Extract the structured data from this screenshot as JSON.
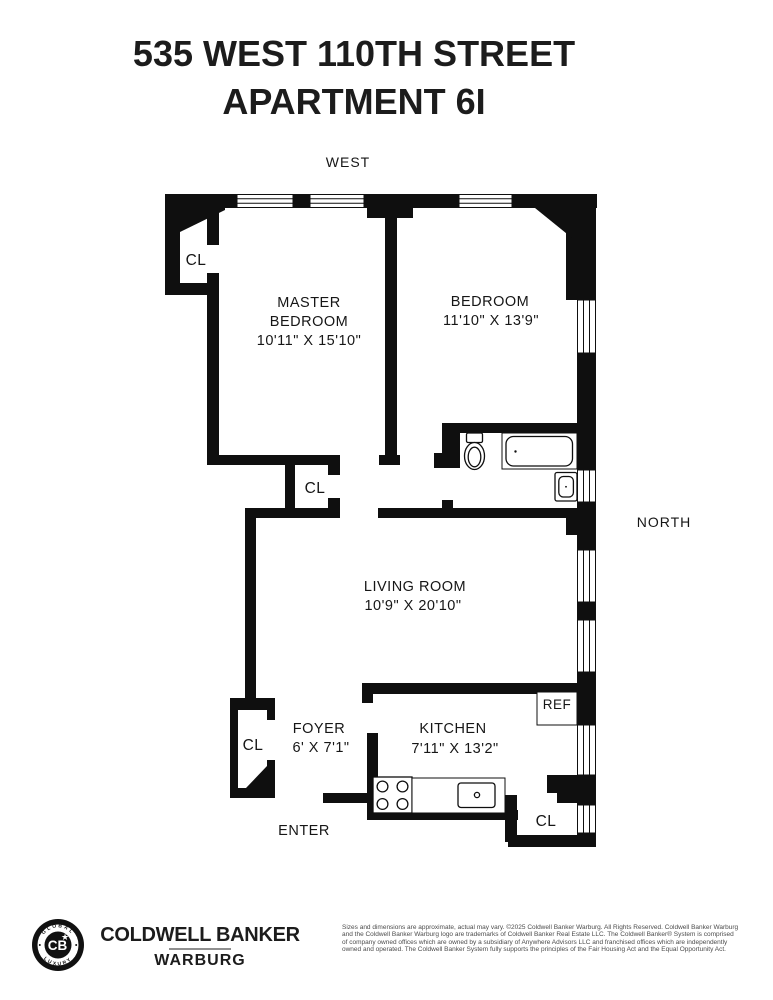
{
  "title": {
    "line1": "535 WEST 110TH STREET",
    "line2": "APARTMENT 6I"
  },
  "compass": {
    "west": "WEST",
    "north": "NORTH"
  },
  "plan": {
    "closet_label": "CL",
    "ref_label": "REF",
    "entry_label": "ENTER",
    "rooms": {
      "master_bedroom": {
        "name1": "MASTER",
        "name2": "BEDROOM",
        "dims": "10'11\" X 15'10\""
      },
      "bedroom": {
        "name": "BEDROOM",
        "dims": "11'10\" X 13'9\""
      },
      "living_room": {
        "name": "LIVING ROOM",
        "dims": "10'9\" X 20'10\""
      },
      "foyer": {
        "name": "FOYER",
        "dims": "6' X 7'1\""
      },
      "kitchen": {
        "name": "KITCHEN",
        "dims": "7'11\" X 13'2\""
      }
    }
  },
  "footer": {
    "logo": {
      "top": "GLOBAL",
      "bottom": "LUXURY",
      "monogram": "CB"
    },
    "brand_line1": "COLDWELL BANKER",
    "brand_line2": "WARBURG",
    "disclaimer": [
      "Sizes and dimensions are approximate, actual may vary. ©2025 Coldwell Banker Warburg. All Rights Reserved. Coldwell Banker Warburg",
      "and the Coldwell Banker Warburg logo are trademarks of Coldwell Banker Real Estate LLC. The Coldwell Banker® System is comprised",
      "of company owned offices which are owned by a subsidiary of Anywhere Advisors LLC and franchised offices which are independently",
      "owned and operated. The Coldwell Banker System fully supports the principles of the Fair Housing Act and the Equal Opportunity Act."
    ]
  },
  "colors": {
    "ink": "#0f0f0f"
  }
}
